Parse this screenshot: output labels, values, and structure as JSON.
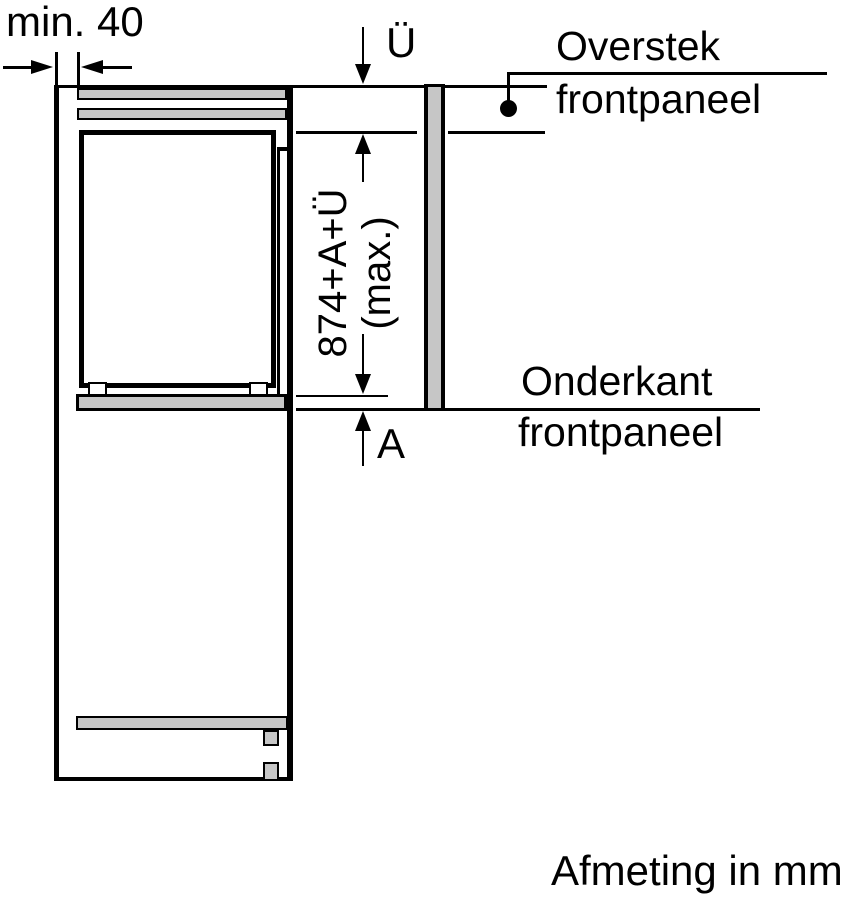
{
  "diagram": {
    "type": "appliance-installation-drawing",
    "colors": {
      "line": "#000000",
      "panel_fill": "#c6c6c6",
      "background": "#ffffff"
    },
    "labels": {
      "min_clearance": "min. 40",
      "overhang_symbol": "Ü",
      "overstek_line1": "Overstek",
      "overstek_line2": "frontpaneel",
      "panel_length_line1": "874+A+Ü",
      "panel_length_line2": "(max.)",
      "onderkant_line1": "Onderkant",
      "onderkant_line2": "frontpaneel",
      "gap_symbol": "A",
      "units_note": "Afmeting in mm"
    }
  }
}
